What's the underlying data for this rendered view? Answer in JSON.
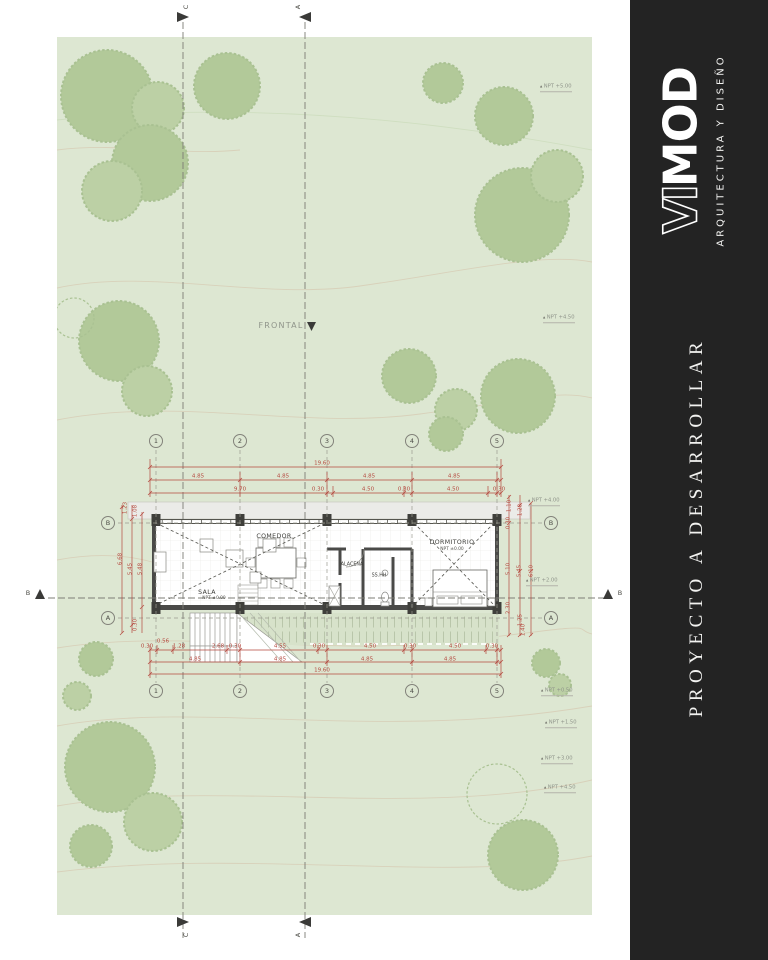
{
  "sidebar": {
    "bg": "#232323",
    "logo_vi": "VI",
    "logo_mod": "MOD",
    "tagline": "ARQUITECTURA Y DISEÑO",
    "title": "PROYECTO A DESARROLLAR"
  },
  "site": {
    "bg": "#dde7d2",
    "tree_color": "#b2c999",
    "contour_color": "#d8d1ba",
    "frontal_label": "FRONTAL",
    "npt_labels": [
      {
        "t": "NPT +5.00",
        "x": 540,
        "y": 88
      },
      {
        "t": "NPT +4.50",
        "x": 543,
        "y": 319
      },
      {
        "t": "NPT +4.00",
        "x": 528,
        "y": 502
      },
      {
        "t": "NPT +2.00",
        "x": 526,
        "y": 582
      },
      {
        "t": "NPT +0.50",
        "x": 541,
        "y": 692
      },
      {
        "t": "NPT +1.50",
        "x": 545,
        "y": 724
      },
      {
        "t": "NPT +3.00",
        "x": 541,
        "y": 760
      },
      {
        "t": "NPT +4.50",
        "x": 544,
        "y": 789
      }
    ]
  },
  "sections": {
    "c_label": "C",
    "a_label": "A",
    "b_label": "B"
  },
  "grid": {
    "circles": [
      {
        "label": "1",
        "x": 156,
        "y": 441
      },
      {
        "label": "2",
        "x": 240,
        "y": 441
      },
      {
        "label": "3",
        "x": 327,
        "y": 441
      },
      {
        "label": "4",
        "x": 412,
        "y": 441
      },
      {
        "label": "5",
        "x": 497,
        "y": 441
      },
      {
        "label": "1",
        "x": 156,
        "y": 691
      },
      {
        "label": "2",
        "x": 240,
        "y": 691
      },
      {
        "label": "3",
        "x": 327,
        "y": 691
      },
      {
        "label": "4",
        "x": 412,
        "y": 691
      },
      {
        "label": "5",
        "x": 497,
        "y": 691
      },
      {
        "label": "B",
        "x": 108,
        "y": 523
      },
      {
        "label": "A",
        "x": 108,
        "y": 618
      },
      {
        "label": "B",
        "x": 551,
        "y": 523
      },
      {
        "label": "A",
        "x": 551,
        "y": 618
      }
    ]
  },
  "plan": {
    "dim_color": "#b5493f",
    "wall_color": "#4a4a48",
    "rooms": [
      {
        "name": "COMEDOR",
        "x": 274,
        "y": 537
      },
      {
        "name": "ALACENA",
        "x": 352,
        "y": 566
      },
      {
        "name": "SS.HH",
        "x": 379,
        "y": 577
      },
      {
        "name": "DORMITORIO",
        "x": 452,
        "y": 543
      },
      {
        "name": "SALA",
        "x": 207,
        "y": 593
      }
    ],
    "dorm_npt": {
      "t": "NPT ±0.00",
      "x": 452,
      "y": 550
    },
    "sala_npt": {
      "t": "NPT ±0.00",
      "x": 214,
      "y": 599
    },
    "dims_h": [
      {
        "t": "19.60",
        "x": 322,
        "y": 464
      },
      {
        "t": "4.85",
        "x": 198,
        "y": 477
      },
      {
        "t": "4.85",
        "x": 283,
        "y": 477
      },
      {
        "t": "4.85",
        "x": 369,
        "y": 477
      },
      {
        "t": "4.85",
        "x": 454,
        "y": 477
      },
      {
        "t": "9.70",
        "x": 240,
        "y": 490
      },
      {
        "t": "0.30",
        "x": 318,
        "y": 490
      },
      {
        "t": "4.50",
        "x": 368,
        "y": 490
      },
      {
        "t": "0.30",
        "x": 404,
        "y": 490
      },
      {
        "t": "4.50",
        "x": 453,
        "y": 490
      },
      {
        "t": "0.30",
        "x": 499,
        "y": 490
      },
      {
        "t": "0.30",
        "x": 147,
        "y": 647
      },
      {
        "t": "0.56",
        "x": 163,
        "y": 642
      },
      {
        "t": "1.28",
        "x": 179,
        "y": 647
      },
      {
        "t": "2.68",
        "x": 218,
        "y": 647
      },
      {
        "t": "0.30",
        "x": 235,
        "y": 647
      },
      {
        "t": "4.55",
        "x": 280,
        "y": 647
      },
      {
        "t": "0.30",
        "x": 319,
        "y": 647
      },
      {
        "t": "4.50",
        "x": 370,
        "y": 647
      },
      {
        "t": "0.30",
        "x": 410,
        "y": 647
      },
      {
        "t": "4.50",
        "x": 455,
        "y": 647
      },
      {
        "t": "0.30",
        "x": 492,
        "y": 647
      },
      {
        "t": "4.85",
        "x": 195,
        "y": 660
      },
      {
        "t": "4.85",
        "x": 280,
        "y": 660
      },
      {
        "t": "4.85",
        "x": 367,
        "y": 660
      },
      {
        "t": "4.85",
        "x": 450,
        "y": 660
      },
      {
        "t": "19.60",
        "x": 322,
        "y": 671
      }
    ],
    "dims_v": [
      {
        "t": "1.23",
        "x": 126,
        "y": 508
      },
      {
        "t": "1.08",
        "x": 136,
        "y": 511
      },
      {
        "t": "6.68",
        "x": 121,
        "y": 559
      },
      {
        "t": "5.45",
        "x": 131,
        "y": 569
      },
      {
        "t": "5.48",
        "x": 141,
        "y": 569
      },
      {
        "t": "0.30",
        "x": 136,
        "y": 625
      },
      {
        "t": "1.10",
        "x": 510,
        "y": 506
      },
      {
        "t": "1.28",
        "x": 521,
        "y": 510
      },
      {
        "t": "0.30",
        "x": 509,
        "y": 523
      },
      {
        "t": "5.10",
        "x": 509,
        "y": 569
      },
      {
        "t": "5.45",
        "x": 520,
        "y": 571
      },
      {
        "t": "6.10",
        "x": 532,
        "y": 571
      },
      {
        "t": "2.30",
        "x": 509,
        "y": 608
      },
      {
        "t": "1.25",
        "x": 521,
        "y": 620
      },
      {
        "t": "1.40",
        "x": 524,
        "y": 630
      }
    ]
  }
}
